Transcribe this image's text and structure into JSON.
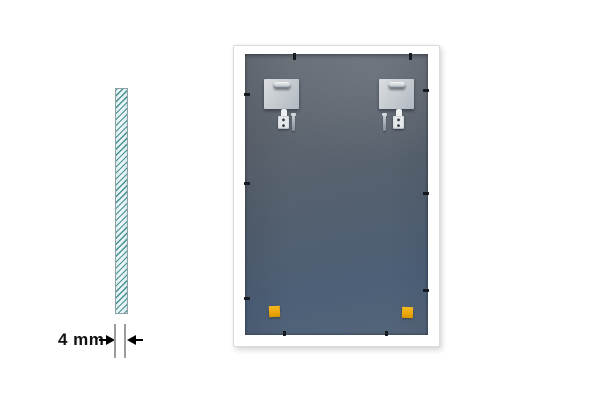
{
  "figure": {
    "type": "product-back-diagram",
    "dimension": {
      "label": "4 mm"
    },
    "parts": {
      "glass_cross_section": "hatched-glass-strip",
      "mounting_plates": 2,
      "hanger_slots": 2,
      "wall_plugs": 2,
      "screws": 2,
      "corner_pads": 2,
      "retainer_clips": 10
    }
  },
  "colors": {
    "background": "#ffffff",
    "frame_white": "#ffffff",
    "panel_gray_top": "#686e76",
    "panel_blue_bottom": "#4d6078",
    "glass_fill": "#e8f3f4",
    "glass_hatch_teal": "#3f8c8c",
    "plate_silver": "#c8cdd2",
    "corner_pad_orange": "#eda70e",
    "clip_black": "#15181c",
    "dimension_text": "#111111",
    "extension_line_gray": "#9c9c9c"
  }
}
